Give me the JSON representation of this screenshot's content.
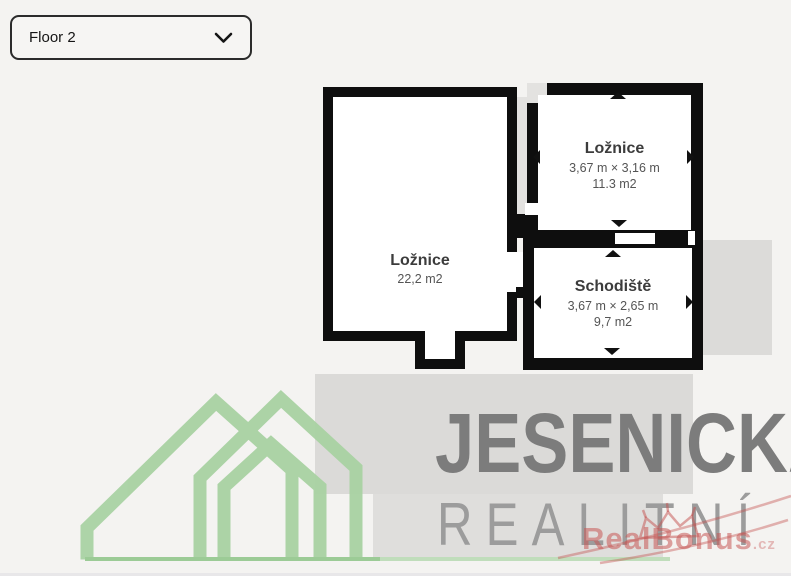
{
  "floor_selector": {
    "value": "Floor 2"
  },
  "floor_plan": {
    "rooms": [
      {
        "name": "Ložnice",
        "area": "22,2 m2"
      },
      {
        "name": "Ložnice",
        "dimensions": "3,67 m × 3,16 m",
        "area": "11.3 m2"
      },
      {
        "name": "Schodiště",
        "dimensions": "3,67 m × 2,65 m",
        "area": "9,7 m2"
      }
    ]
  },
  "watermarks": {
    "agency": {
      "line1": "JESENICKÁ",
      "line2": "REALITNÍ"
    },
    "portal": {
      "name": "RealBonus",
      "suffix": ".cz"
    }
  },
  "colors": {
    "background": "#f4f3f1",
    "wall": "#0e0e0e",
    "room_fill": "#ffffff",
    "shadow_gray": "#dcdbd9",
    "logo_green": "#a9d2a3",
    "agency_text_dark": "#7c7c7c",
    "agency_text_light": "#9c9c9c",
    "portal_red": "#c75856"
  }
}
